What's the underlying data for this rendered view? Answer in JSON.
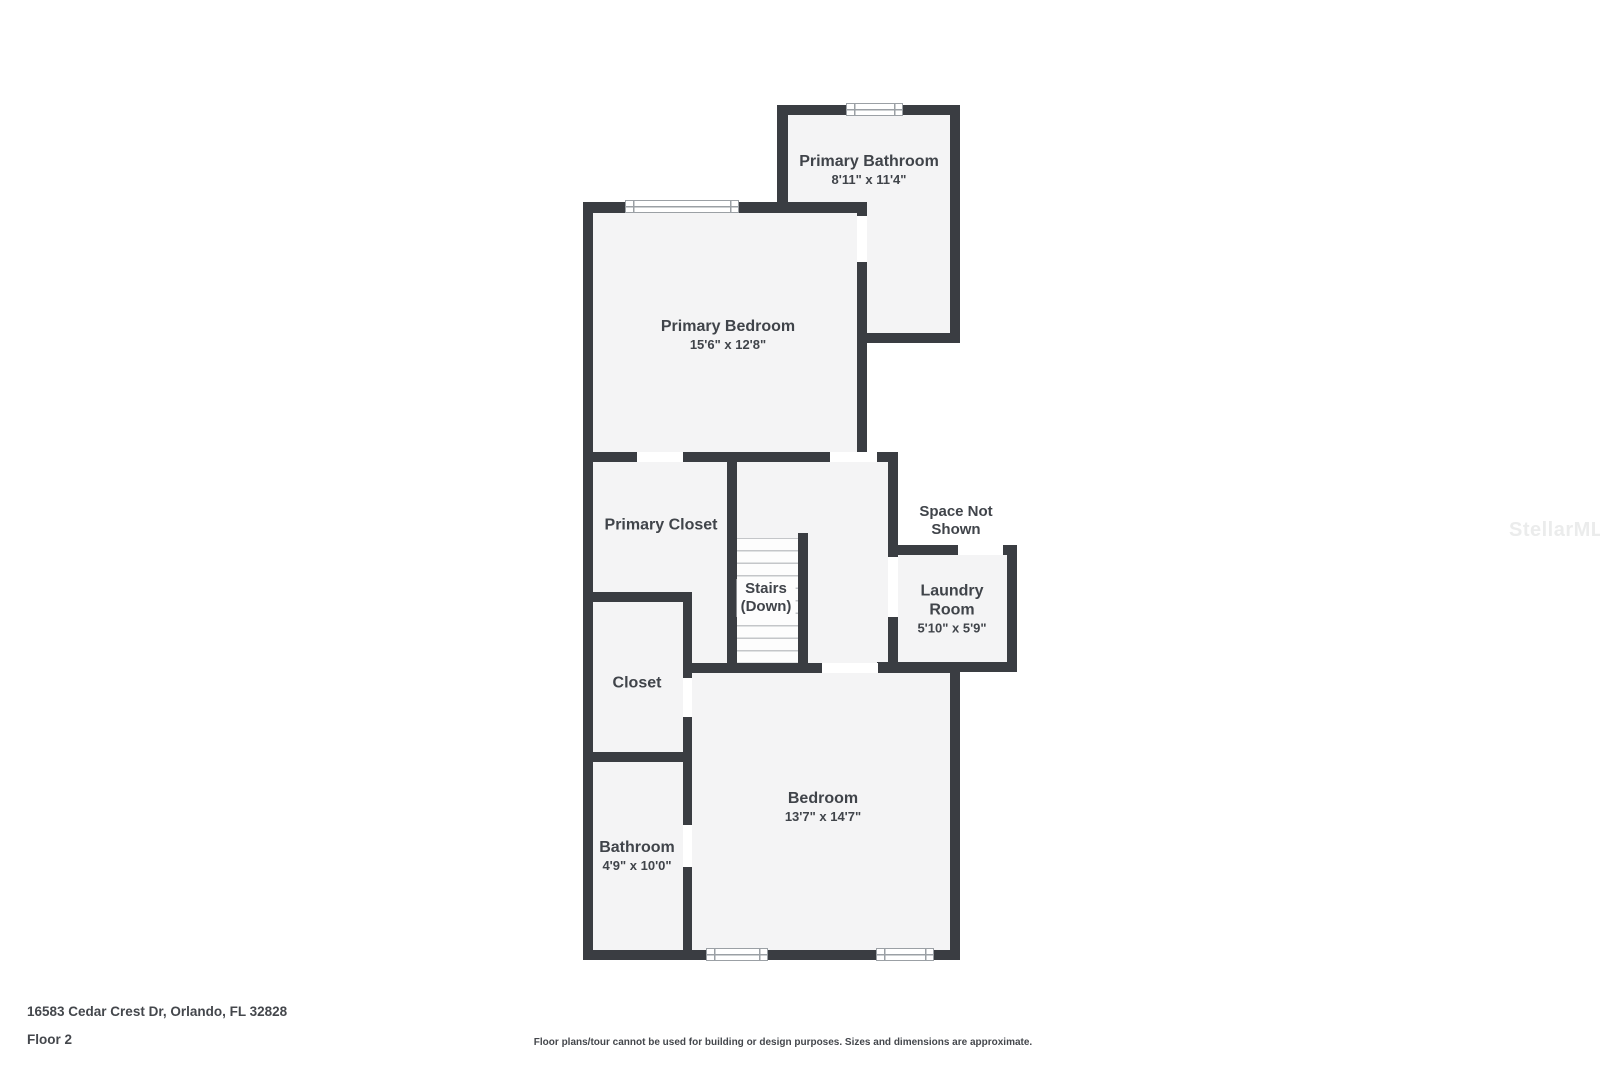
{
  "floor_plan": {
    "rooms": {
      "primary_bathroom": {
        "name": "Primary Bathroom",
        "dims": "8'11\" x 11'4\""
      },
      "primary_bedroom": {
        "name": "Primary Bedroom",
        "dims": "15'6\" x 12'8\""
      },
      "primary_closet": {
        "name": "Primary Closet"
      },
      "stairs": {
        "name": "Stairs",
        "direction": "(Down)"
      },
      "space_not_shown": {
        "lines": [
          "Space Not",
          "Shown"
        ]
      },
      "laundry_room": {
        "lines": [
          "Laundry",
          "Room"
        ],
        "dims": "5'10\" x 5'9\""
      },
      "closet": {
        "name": "Closet"
      },
      "bedroom": {
        "name": "Bedroom",
        "dims": "13'7\" x 14'7\""
      },
      "bathroom": {
        "name": "Bathroom",
        "dims": "4'9\" x 10'0\""
      }
    },
    "footer": {
      "address": "16583 Cedar Crest Dr, Orlando, FL 32828",
      "floor_label": "Floor 2",
      "disclaimer": "Floor plans/tour cannot be used for building or design purposes. Sizes and dimensions are approximate."
    },
    "watermark": "StellarMLS",
    "colors": {
      "wall": "#3a3d42",
      "room_fill": "#f4f4f5",
      "text": "#40444a",
      "background": "#ffffff",
      "tread_line": "#c4c6c9",
      "window_line": "#9ba0a5",
      "watermark_color": "#ebecec"
    }
  }
}
